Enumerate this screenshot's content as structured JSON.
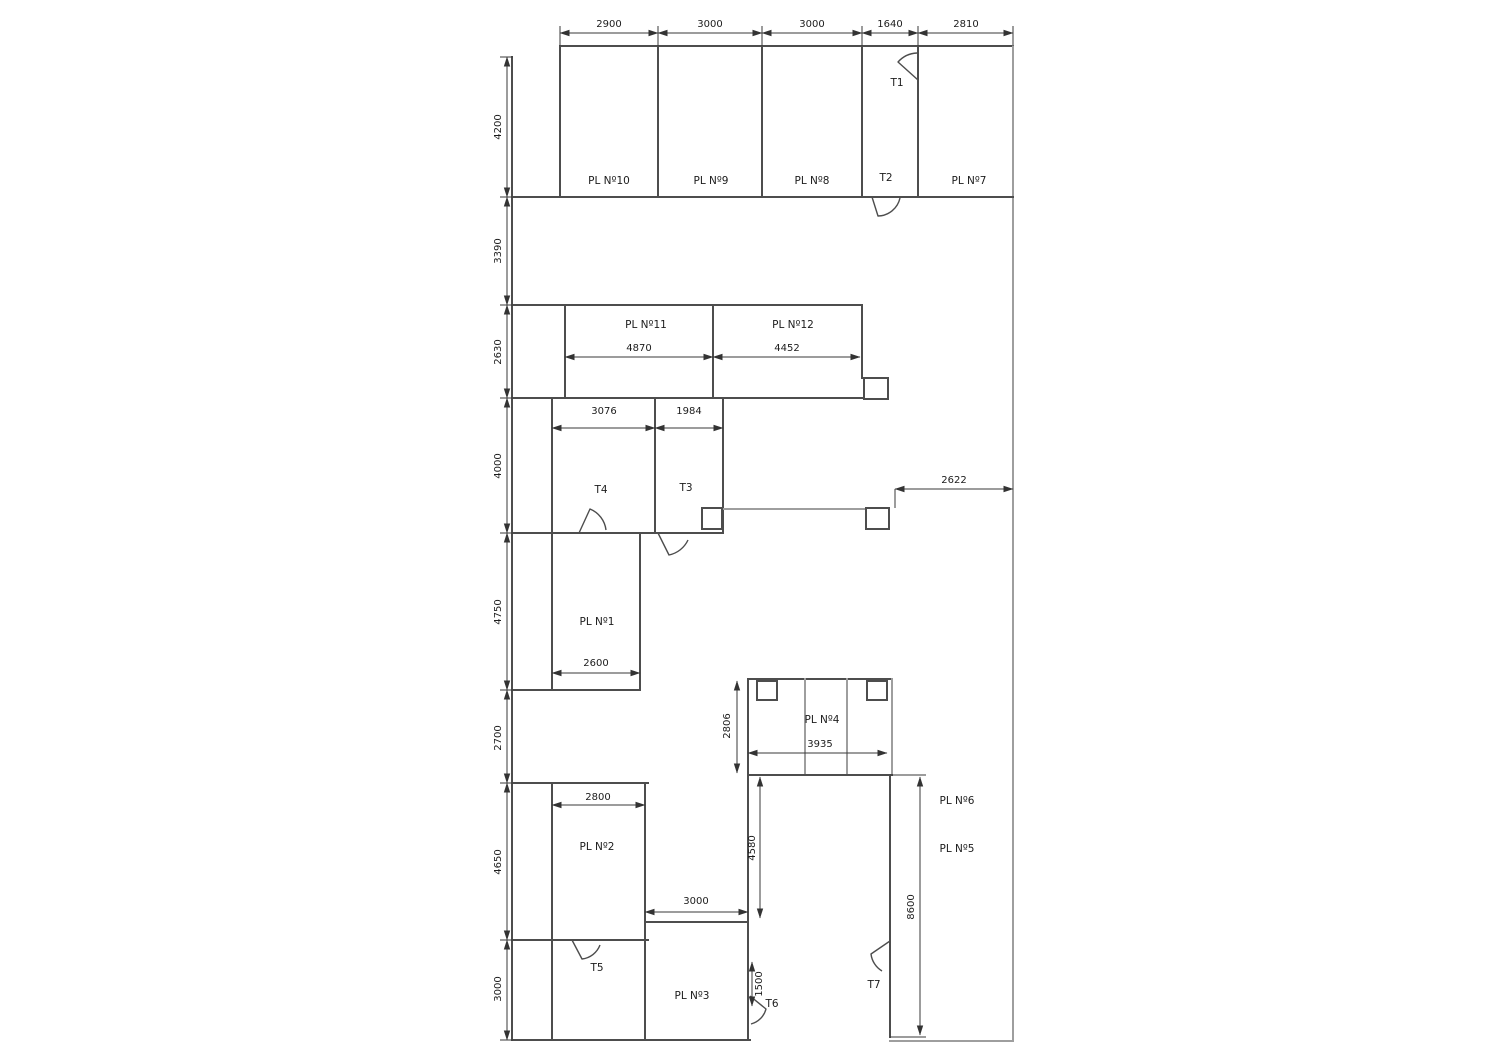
{
  "drawing": {
    "kind": "architectural floor plan",
    "wall_color": "#4d4d4d",
    "light_wall_color": "#9e9e9e",
    "background": "#ffffff"
  },
  "rooms": {
    "pl1": "PL Nº1",
    "pl2": "PL Nº2",
    "pl3": "PL Nº3",
    "pl4": "PL Nº4",
    "pl5": "PL Nº5",
    "pl6": "PL Nº6",
    "pl7": "PL Nº7",
    "pl8": "PL Nº8",
    "pl9": "PL Nº9",
    "pl10": "PL Nº10",
    "pl11": "PL Nº11",
    "pl12": "PL Nº12"
  },
  "doors": {
    "t1": "T1",
    "t2": "T2",
    "t3": "T3",
    "t4": "T4",
    "t5": "T5",
    "t6": "T6",
    "t7": "T7"
  },
  "dimensions": {
    "top": [
      "2900",
      "3000",
      "3000",
      "1640",
      "2810"
    ],
    "left": [
      "4200",
      "3390",
      "2630",
      "4000",
      "4750",
      "2700",
      "4650",
      "3000"
    ],
    "pl11_width": "4870",
    "pl12_width": "4452",
    "t4_width": "3076",
    "t3_width": "1984",
    "pl1_width": "2600",
    "right_corridor": "2622",
    "pl4_height": "2806",
    "pl4_width": "3935",
    "pl2_width": "2800",
    "pl3_width": "3000",
    "passage_height": "4580",
    "t6_opening": "1500",
    "right_wing_height": "8600"
  }
}
